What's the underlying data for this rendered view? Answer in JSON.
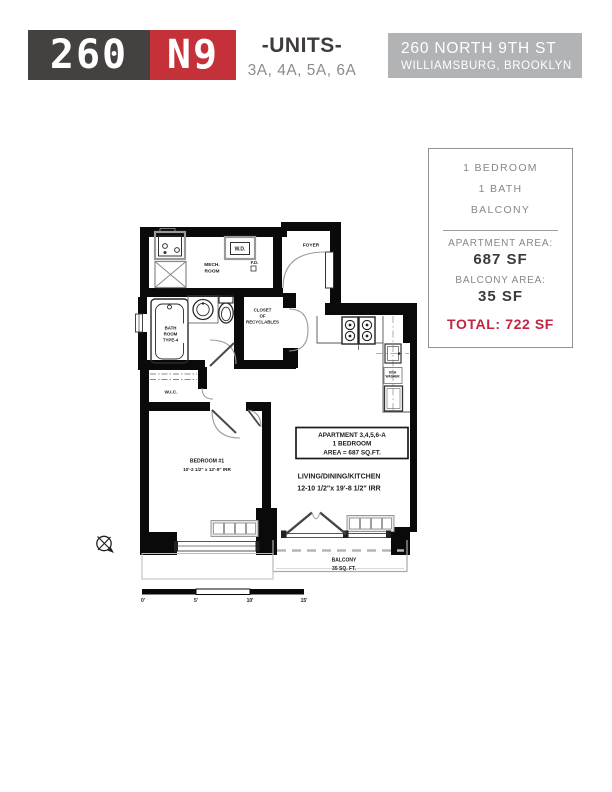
{
  "header": {
    "logo": {
      "part1": "260",
      "part2": "N9",
      "dark_bg": "#454140",
      "red_bg": "#c53138"
    },
    "units_title": "-UNITS-",
    "units_list": "3A, 4A, 5A, 6A",
    "address": {
      "line1": "260 NORTH 9TH ST",
      "line2": "WILLIAMSBURG, BROOKLYN"
    }
  },
  "info_panel": {
    "features": [
      "1 BEDROOM",
      "1 BATH",
      "BALCONY"
    ],
    "apartment_area_label": "APARTMENT AREA:",
    "apartment_area_value": "687 SF",
    "balcony_area_label": "BALCONY AREA:",
    "balcony_area_value": "35 SF",
    "total_label": "TOTAL:",
    "total_value": "722 SF"
  },
  "floor_plan": {
    "rooms": {
      "foyer": "FOYER",
      "mech_1": "MECH.",
      "mech_2": "ROOM",
      "fd": "F.D.",
      "wd": "W.D.",
      "closet_1": "CLOSET",
      "closet_2": "OF",
      "closet_3": "RECYCLABLES",
      "bath_1": "BATH",
      "bath_2": "ROOM",
      "bath_3": "TYPE-4",
      "wic": "W.I.C.",
      "bedroom_name": "BEDROOM #1",
      "bedroom_dims": "10'-2 1/2\" x 12'-9\" IRR",
      "dw_1": "DISH",
      "dw_2": "WASHER"
    },
    "apartment_box": {
      "line1": "APARTMENT 3,4,5,6-A",
      "line2": "1 BEDROOM",
      "line3": "AREA = 687 SQ.FT."
    },
    "living": {
      "name": "LIVING/DINING/KITCHEN",
      "dims": "12-10 1/2\"x 19'-8 1/2\" IRR"
    },
    "balcony": {
      "name": "BALCONY",
      "area": "35 SQ. FT."
    },
    "scale_bar": {
      "ticks": [
        "0'",
        "5'",
        "10'",
        "15'"
      ]
    }
  }
}
